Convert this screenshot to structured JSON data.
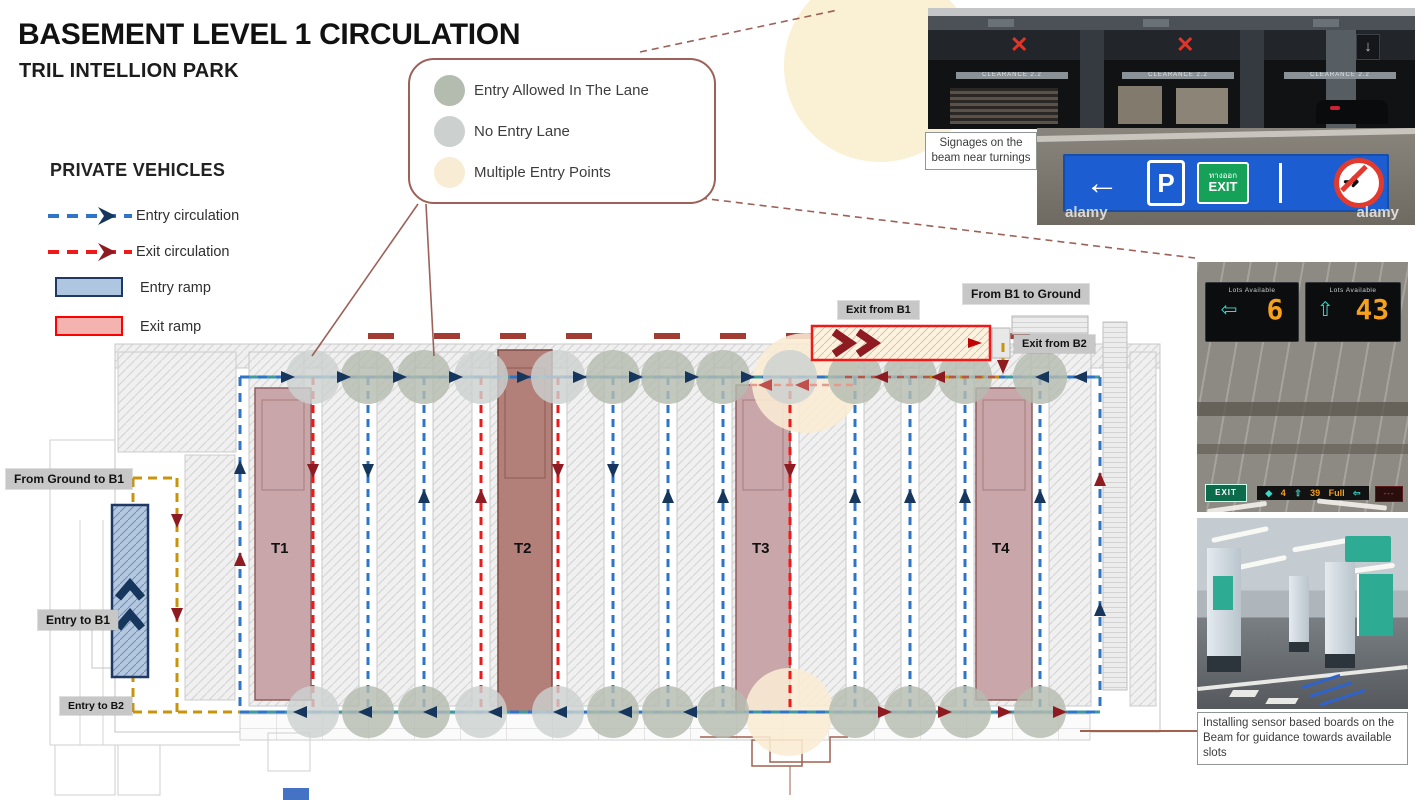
{
  "header": {
    "title": "BASEMENT LEVEL 1 CIRCULATION",
    "subtitle": "TRIL INTELLION PARK"
  },
  "zone_legend": {
    "items": [
      {
        "label": "Entry  Allowed In The Lane",
        "color": "#b4bcb0"
      },
      {
        "label": "No Entry  Lane",
        "color": "#ccd1d0"
      },
      {
        "label": "Multiple Entry Points",
        "color": "#f9ecd4"
      }
    ]
  },
  "vehicle_legend": {
    "heading": "PRIVATE VEHICLES",
    "entry_circulation": "Entry circulation",
    "exit_circulation": "Exit circulation",
    "entry_ramp": "Entry ramp",
    "exit_ramp": "Exit ramp"
  },
  "plan": {
    "towers": [
      "T1",
      "T2",
      "T3",
      "T4"
    ],
    "labels": {
      "exit_from_b1": "Exit from B1",
      "from_b1_to_ground": "From B1 to Ground",
      "exit_from_b2": "Exit from B2",
      "from_ground_to_b1": "From Ground to B1",
      "entry_to_b1": "Entry to B1",
      "entry_to_b2": "Entry to B2"
    },
    "colors": {
      "entry": "#2e75c9",
      "entry_alt": "#3f9aa0",
      "entry_arrow": "#17365d",
      "exit": "#f01818",
      "exit_arrow": "#8f1b22",
      "ramp_path": "#c8940c",
      "exit_overlay": "#b5564d",
      "salmon": "#e59a90",
      "entry_allowed_circle": "#b4bcb0",
      "no_entry_circle": "#ccd1d0",
      "multiple_entry": "#f9ecd4"
    },
    "lanes": [
      {
        "x": 313,
        "kind": "exit",
        "dir": "down"
      },
      {
        "x": 368,
        "kind": "entry",
        "dir": "down"
      },
      {
        "x": 424,
        "kind": "entry",
        "dir": "up"
      },
      {
        "x": 481,
        "kind": "exit",
        "dir": "up"
      },
      {
        "x": 558,
        "kind": "exit",
        "dir": "down"
      },
      {
        "x": 613,
        "kind": "entry",
        "dir": "down"
      },
      {
        "x": 668,
        "kind": "entry",
        "dir": "up"
      },
      {
        "x": 723,
        "kind": "entry",
        "dir": "up"
      },
      {
        "x": 790,
        "kind": "exit",
        "dir": "down"
      },
      {
        "x": 855,
        "kind": "entry",
        "dir": "up"
      },
      {
        "x": 910,
        "kind": "entry",
        "dir": "up"
      },
      {
        "x": 965,
        "kind": "entry",
        "dir": "up"
      },
      {
        "x": 1040,
        "kind": "entry",
        "dir": "up"
      }
    ]
  },
  "photos": {
    "caption_top": "Signages on the beam near turnings",
    "caption_bottom": "Installing sensor based boards on the Beam for guidance towards available slots",
    "beam_signage": {
      "clearance": "CLEARANCE 2.2",
      "x_mark": "✕",
      "down_arrow": "↓"
    },
    "blue_sign": {
      "left_arrow": "←",
      "p": "P",
      "exit_thai": "ทางออก",
      "exit_en": "EXIT",
      "no_turn_arrow": "➜",
      "watermark": "alamy"
    },
    "lots_boards": {
      "title": "Lots  Available",
      "left_arrow": "⇦",
      "left_value": "6",
      "up_arrow": "⇧",
      "right_value": "43",
      "bottom_exit": "EXIT",
      "bottom_v1": "4",
      "bottom_v2": "39",
      "bottom_full": "Full"
    }
  }
}
